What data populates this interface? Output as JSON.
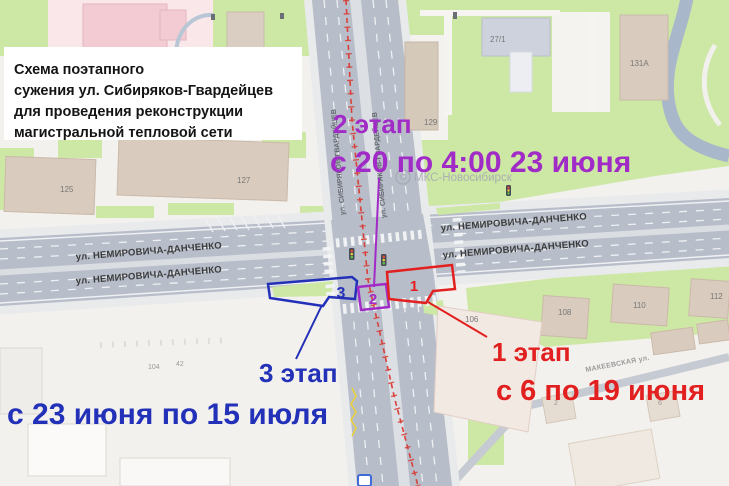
{
  "title_box": {
    "line1": "Схема поэтапного",
    "line2": "сужения ул. Сибиряков-Гвардейцев",
    "line3": "для проведения реконструкции",
    "line4": "магистральной тепловой сети"
  },
  "stages": {
    "stage1": {
      "name": "1 этап",
      "dates": "с 6 по 19 июня",
      "zone": "1",
      "color": "#e22020"
    },
    "stage2": {
      "name": "2 этап",
      "dates": "с 20 по 4:00 23 июня",
      "zone": "2",
      "color": "#a12bc7"
    },
    "stage3": {
      "name": "3 этап",
      "dates": "с 23 июня по 15 июля",
      "zone": "3",
      "color": "#2231b8"
    }
  },
  "streets": {
    "nemirovicha_danchenko": "ул. НЕМИРОВИЧА-ДАНЧЕНКО",
    "sibiryakov_gvardeytsev": "ул. СИБИРЯКОВ-ГВАРДЕЙЦЕВ",
    "makeevskaya": "МАКЕЕВСКАЯ ул."
  },
  "watermark": "МКС-Новосибирск",
  "buildings": {
    "b125": "125",
    "b127": "127",
    "b129": "129",
    "b27_1": "27/1",
    "b131a": "131А",
    "b108": "108",
    "b110": "110",
    "b112": "112",
    "b106": "106",
    "b104": "104",
    "b42": "42",
    "b2": "2",
    "b6": "6"
  },
  "icons": {
    "traffic_light": "traffic-light-icon",
    "watermark_logo": "watermark-logo-icon",
    "bus_stop": "bus-stop-icon"
  },
  "map_colors": {
    "green": "#cde7a4",
    "road": "#b7bdc9",
    "background": "#f3f1ee",
    "heat_line": "#d9403a"
  }
}
